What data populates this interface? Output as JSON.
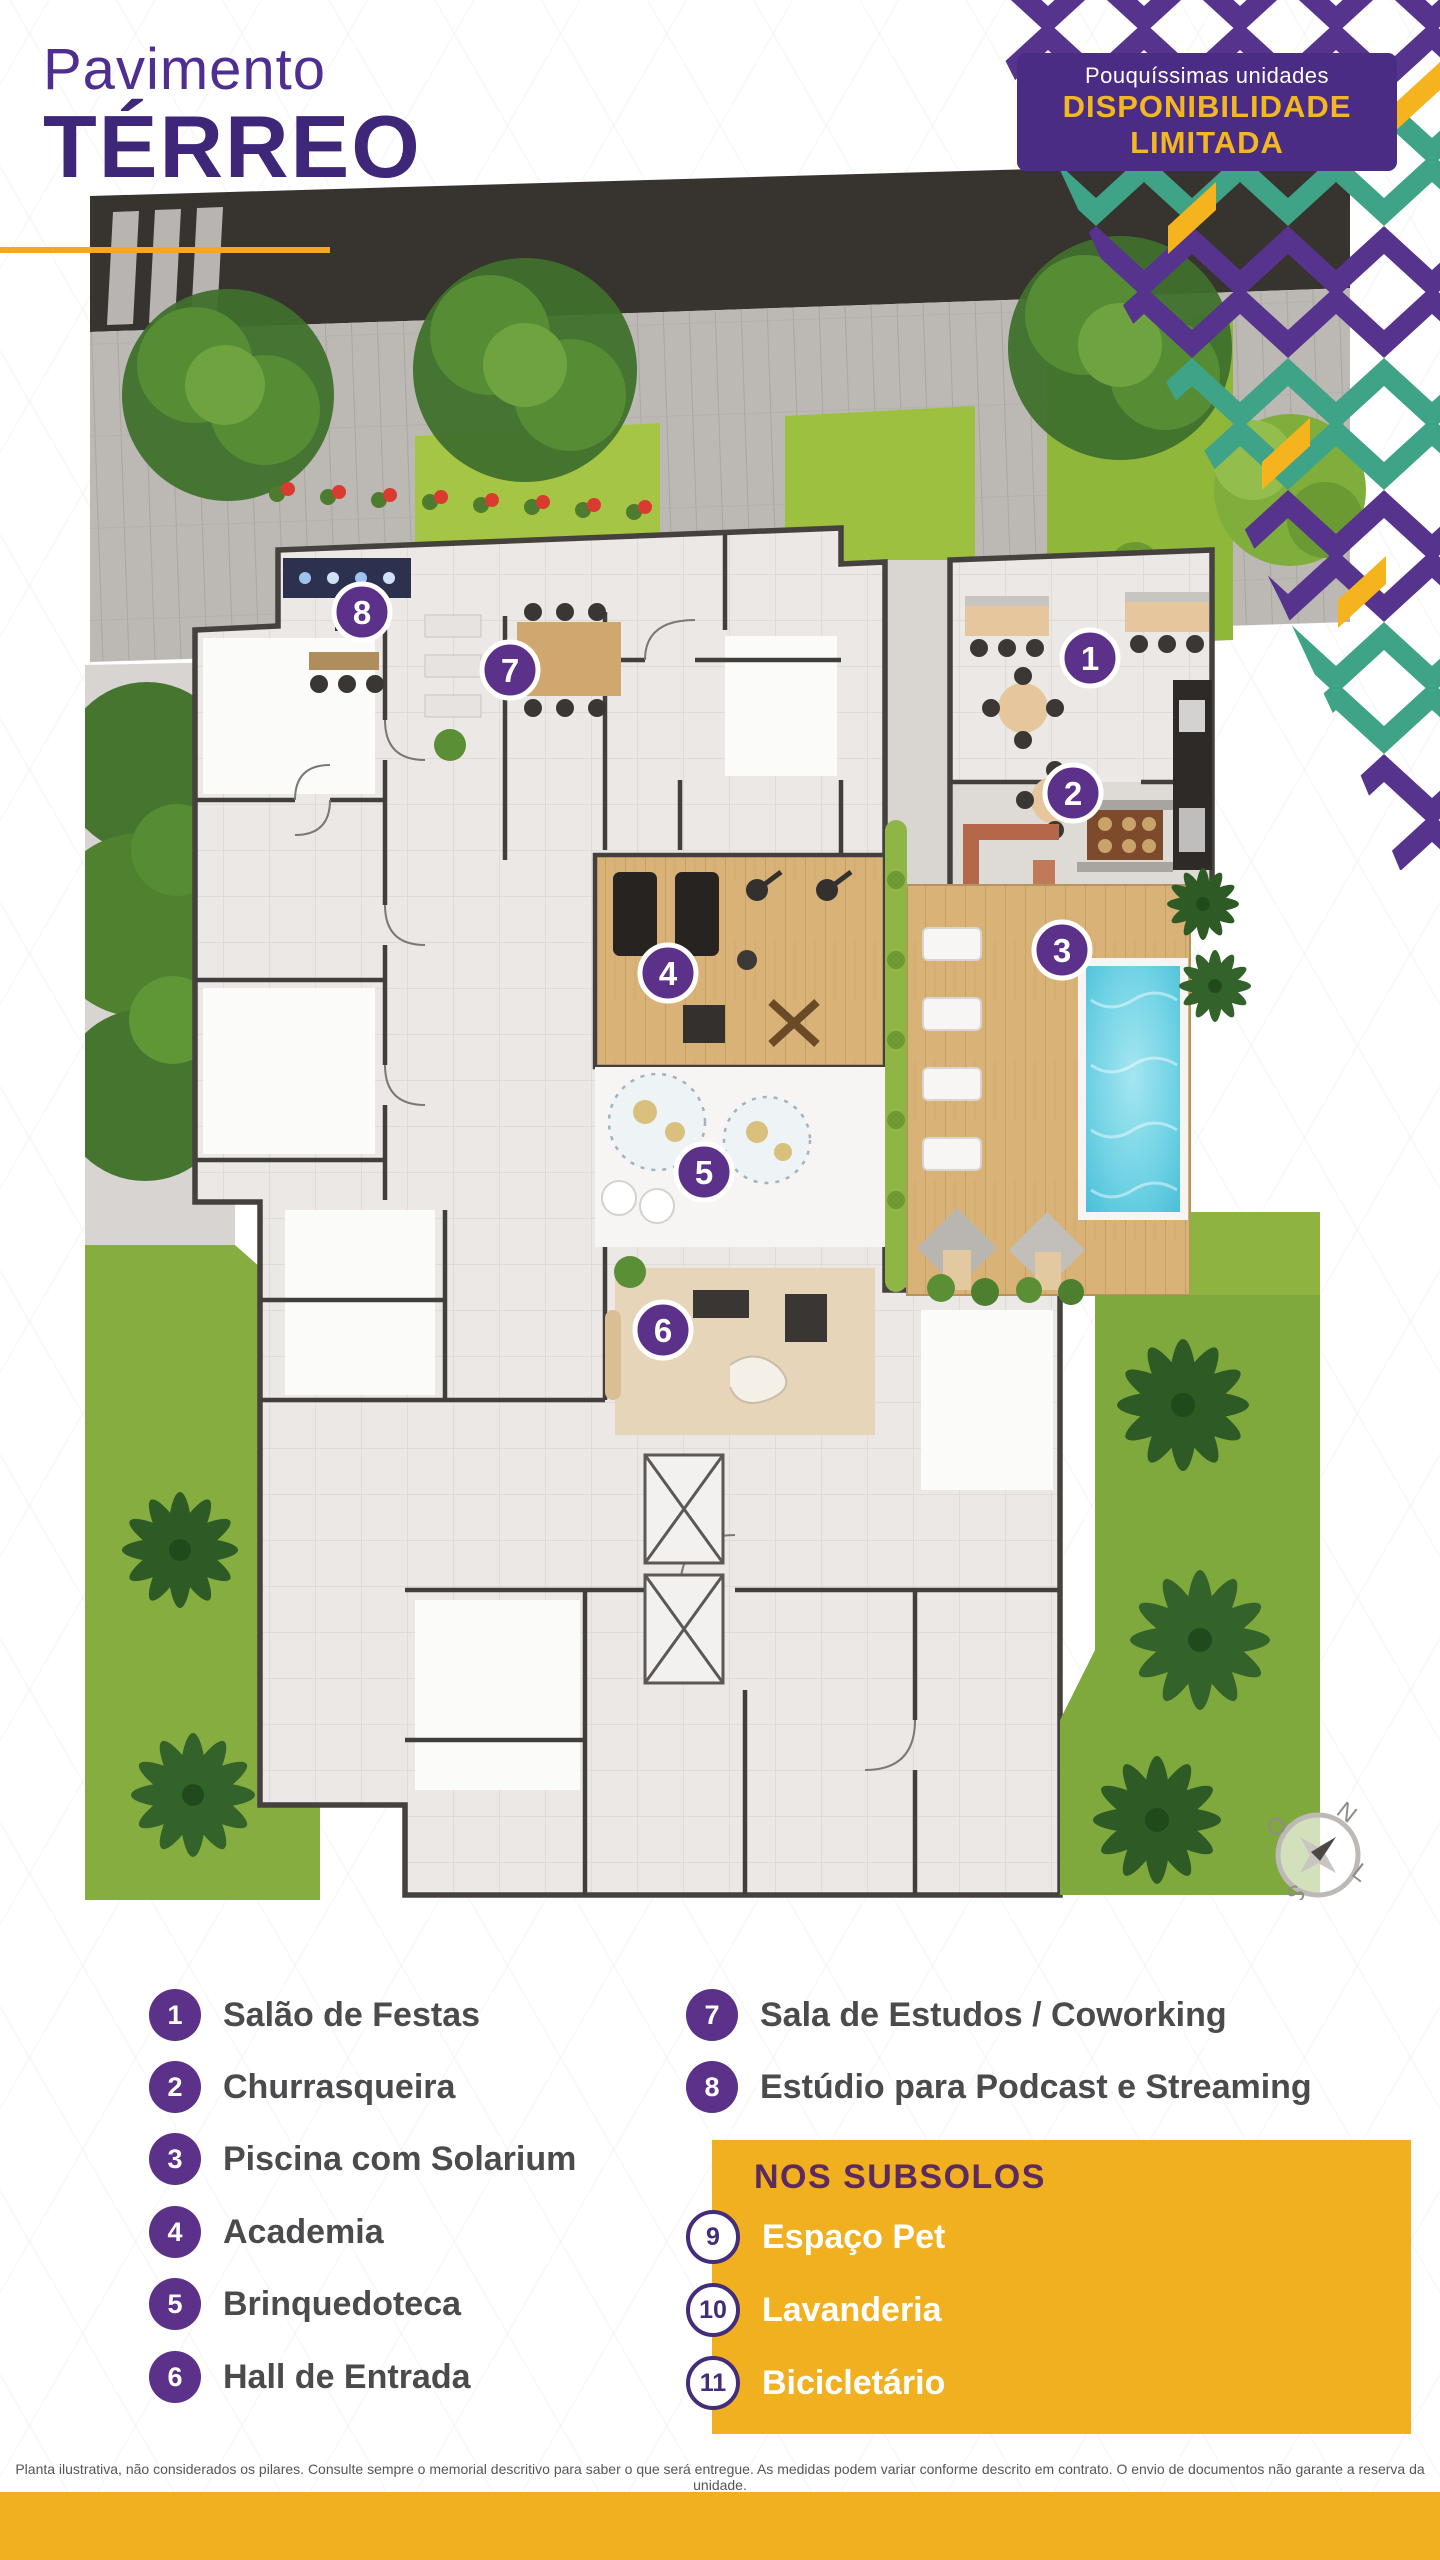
{
  "header": {
    "title_line1": "Pavimento",
    "title_line2": "TÉRREO"
  },
  "badge": {
    "line1": "Pouquíssimas unidades",
    "line2": "DISPONIBILIDADE",
    "line3": "LIMITADA"
  },
  "plan": {
    "markers": [
      {
        "number": "1"
      },
      {
        "number": "2"
      },
      {
        "number": "3"
      },
      {
        "number": "4"
      },
      {
        "number": "5"
      },
      {
        "number": "6"
      },
      {
        "number": "7"
      },
      {
        "number": "8"
      }
    ],
    "compass": {
      "n": "N",
      "l": "L",
      "s": "S",
      "o": "O"
    }
  },
  "legend": {
    "items": [
      {
        "number": "1",
        "label": "Salão de Festas"
      },
      {
        "number": "2",
        "label": "Churrasqueira"
      },
      {
        "number": "3",
        "label": "Piscina com Solarium"
      },
      {
        "number": "4",
        "label": "Academia"
      },
      {
        "number": "5",
        "label": "Brinquedoteca"
      },
      {
        "number": "6",
        "label": "Hall de Entrada"
      },
      {
        "number": "7",
        "label": "Sala de Estudos / Coworking"
      },
      {
        "number": "8",
        "label": "Estúdio para Podcast e Streaming"
      }
    ],
    "subsolos": {
      "title": "NOS SUBSOLOS",
      "items": [
        {
          "number": "9",
          "label": "Espaço Pet"
        },
        {
          "number": "10",
          "label": "Lavanderia"
        },
        {
          "number": "11",
          "label": "Bicicletário"
        }
      ]
    }
  },
  "footer": {
    "disclaimer": "Planta ilustrativa, não considerados os pilares. Consulte sempre o memorial descritivo para saber o que será entregue. As medidas podem variar conforme descrito em contrato. O envio de documentos não garante a reserva da unidade."
  },
  "colors": {
    "brand_purple": "#4a2c85",
    "marker_purple": "#5b3189",
    "accent_teal": "#3fa387",
    "accent_yellow": "#f1b01f",
    "pool_blue": "#5cc9df"
  }
}
